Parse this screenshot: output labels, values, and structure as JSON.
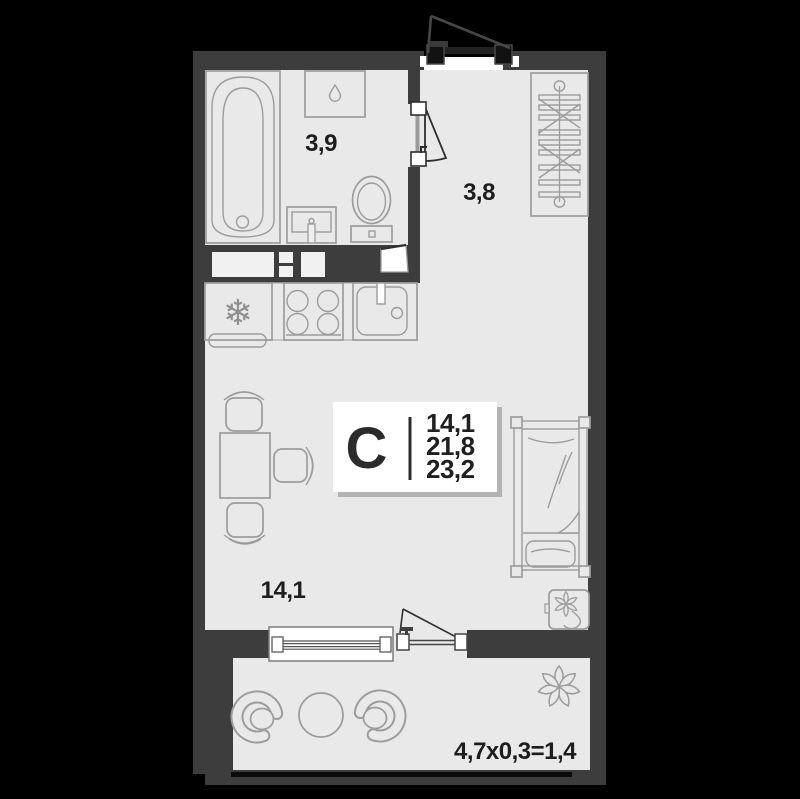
{
  "floorplan": {
    "stat_box": {
      "unit_type": "С",
      "living_area": "14,1",
      "area_without_balcony": "21,8",
      "total_area": "23,2"
    },
    "room_labels": {
      "bathroom": "3,9",
      "hallway": "3,8",
      "living_room": "14,1"
    },
    "balcony_formula": "4,7x0,3=1,4",
    "icons": {
      "snowflake": "❄"
    },
    "colors": {
      "background": "#000000",
      "wall": "#3d3d3d",
      "floor": "#e9e9e9",
      "furniture_outline": "#9c9c9c",
      "label_text": "#1d1d1d",
      "stat_box_bg": "#ffffff",
      "stat_box_shadow": "#b3b3b3",
      "railing": "#0a0a0a"
    }
  }
}
